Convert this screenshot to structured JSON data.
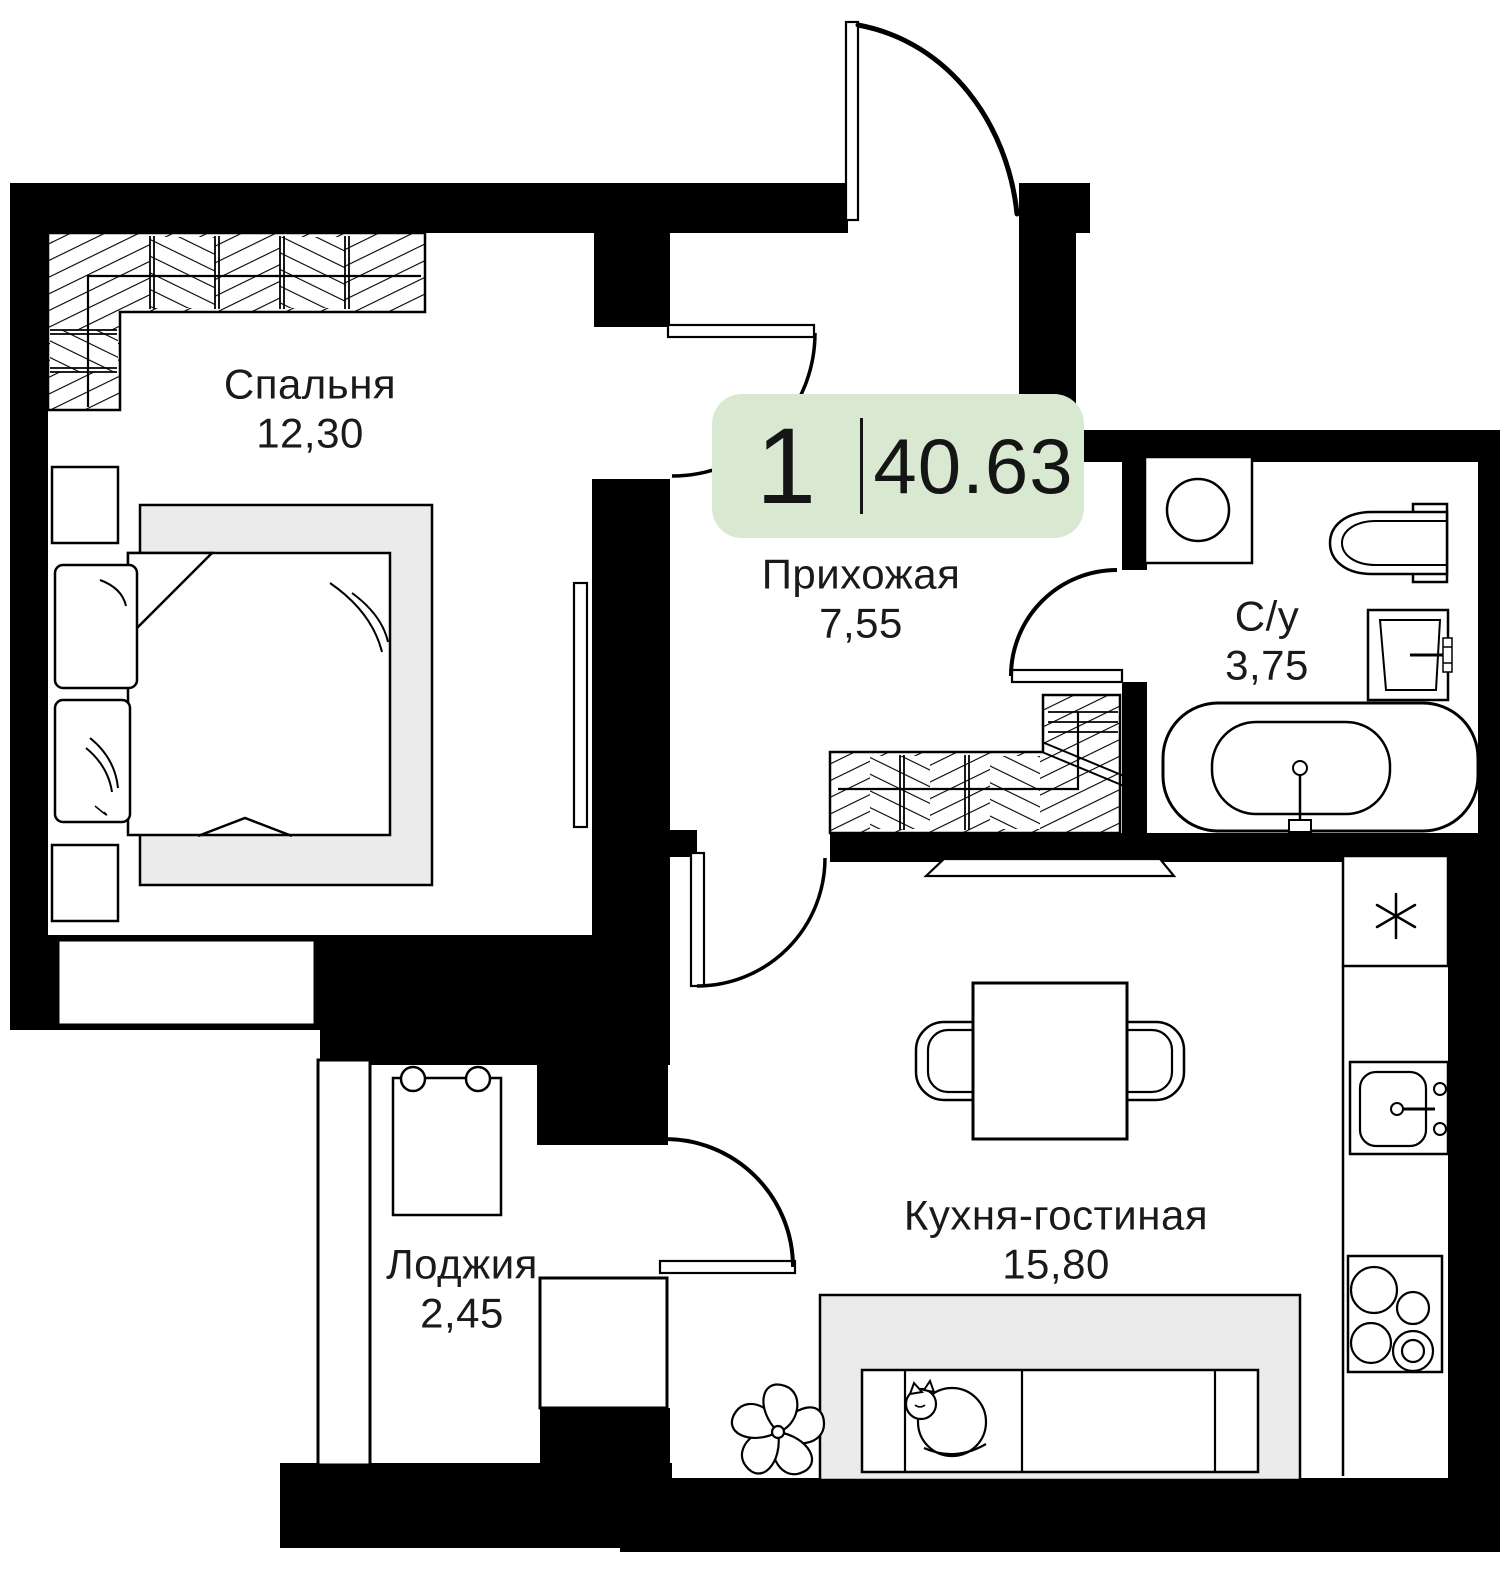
{
  "plan": {
    "badge": {
      "rooms_count": "1",
      "total_area": "40.63"
    },
    "rooms": {
      "bedroom": {
        "name": "Спальня",
        "area": "12,30"
      },
      "hallway": {
        "name": "Прихожая",
        "area": "7,55"
      },
      "bathroom": {
        "name": "С/у",
        "area": "3,75"
      },
      "kitchen_living": {
        "name": "Кухня-гостиная",
        "area": "15,80"
      },
      "loggia": {
        "name": "Лоджия",
        "area": "2,45"
      }
    },
    "colors": {
      "badge_bg": "#d8e8d1",
      "wall": "#000000",
      "furniture_fill": "#ebebeb",
      "text": "#1a1a1a"
    },
    "icons": {
      "fridge": "snowflake-icon",
      "sofa": "sleeping-cat-icon",
      "kitchen": "plant-icon"
    }
  }
}
